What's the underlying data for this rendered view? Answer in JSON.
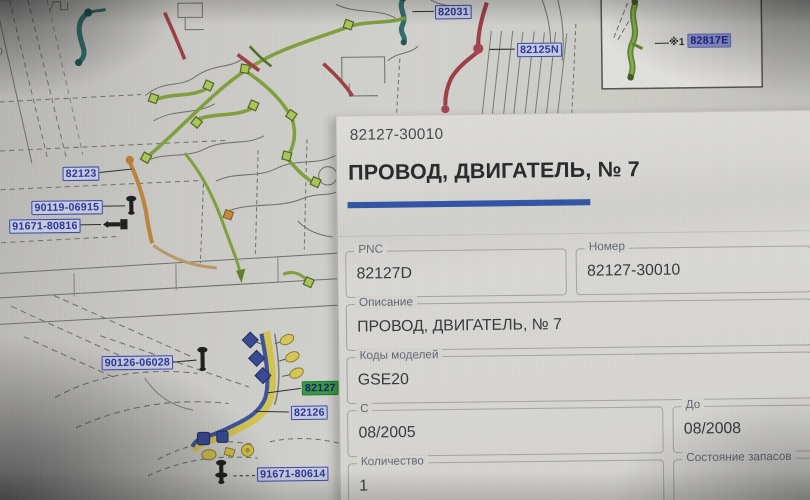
{
  "panel": {
    "part_number": "82127-30010",
    "title": "ПРОВОД, ДВИГАТЕЛЬ, № 7",
    "accent_color": "#2b53b2",
    "fields": {
      "pnc": {
        "label": "PNC",
        "value": "82127D"
      },
      "number": {
        "label": "Номер",
        "value": "82127-30010"
      },
      "description": {
        "label": "Описание",
        "value": "ПРОВОД, ДВИГАТЕЛЬ, № 7"
      },
      "model_codes": {
        "label": "Коды моделей",
        "value": "GSE20"
      },
      "date_from": {
        "label": "С",
        "value": "08/2005"
      },
      "date_to": {
        "label": "До",
        "value": "08/2008"
      },
      "quantity": {
        "label": "Количество",
        "value": "1"
      },
      "stock": {
        "label": "Состояние запасов",
        "value": ""
      }
    }
  },
  "diagram": {
    "labels": [
      {
        "text": "82031",
        "kind": "normal"
      },
      {
        "text": "82125N",
        "kind": "normal"
      },
      {
        "text": "82123",
        "kind": "normal"
      },
      {
        "text": "90119-06915",
        "kind": "normal"
      },
      {
        "text": "91671-80816",
        "kind": "normal"
      },
      {
        "text": "90126-06028",
        "kind": "normal"
      },
      {
        "text": "82127",
        "kind": "selected-green"
      },
      {
        "text": "82126",
        "kind": "normal"
      },
      {
        "text": "91671-80614",
        "kind": "normal"
      }
    ],
    "inset": {
      "note": "※1",
      "label": "82817E"
    },
    "label_color": "#2433a4",
    "selected_highlight_color": "#2f9d3a",
    "inset_highlight_color": "#8f99e2"
  }
}
